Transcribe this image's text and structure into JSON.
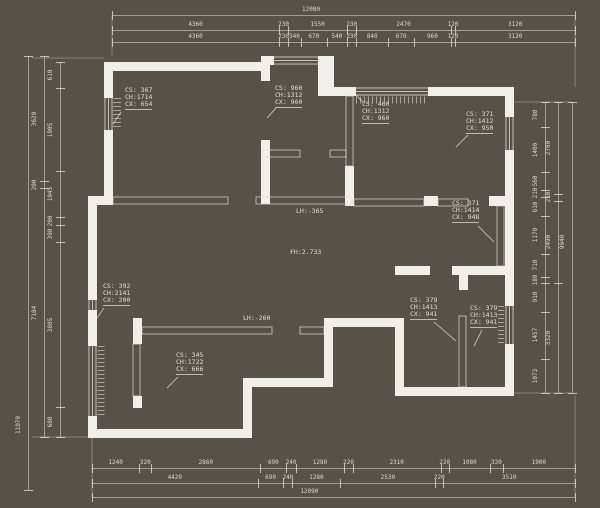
{
  "colors": {
    "background": "#5a5146",
    "wall": "#f2efe8",
    "line": "#d8d0bd",
    "text": "#e2dccb"
  },
  "dimensions": {
    "top_overall": [
      "12080"
    ],
    "top_row2": [
      "4360",
      "230",
      "1550",
      "230",
      "2470",
      "120",
      "3120"
    ],
    "top_row3": [
      "4360",
      "230",
      "340",
      "670",
      "540",
      "230",
      "840",
      "670",
      "960",
      "120",
      "3120"
    ],
    "bottom_row1": [
      "1240",
      "320",
      "2860",
      "690",
      "240",
      "1280",
      "220",
      "2310",
      "220",
      "1080",
      "330",
      "1900"
    ],
    "bottom_row2": [
      "4420",
      "690",
      "240",
      "1280",
      "2530",
      "220",
      "3510"
    ],
    "bottom_overall": [
      "12090"
    ],
    "left_overall": [
      "11070"
    ],
    "left_middle": [
      "3620",
      "200",
      "7184"
    ],
    "left_inner": [
      "610",
      "1905",
      "1045",
      "200",
      "390",
      "3805",
      "680"
    ],
    "right_inner": [
      "780",
      "1400",
      "560",
      "210",
      "610",
      "1170",
      "710",
      "180",
      "910",
      "1457",
      "1073"
    ],
    "right_middle": [
      "2780",
      "210",
      "2490",
      "3320"
    ],
    "right_overall": [
      "9940"
    ]
  },
  "cs_labels": [
    {
      "l1": "CS: 367",
      "l2": "CH:1714",
      "l3": "CX: 654"
    },
    {
      "l1": "CS: 960",
      "l2": "CH:1312",
      "l3": "CX: 960"
    },
    {
      "l1": "CS: 460",
      "l2": "CH:1312",
      "l3": "CX: 960"
    },
    {
      "l1": "CS: 371",
      "l2": "CH:1412",
      "l3": "CX: 950"
    },
    {
      "l1": "CS: 371",
      "l2": "CH:1414",
      "l3": "CX: 948"
    },
    {
      "l1": "CS: 392",
      "l2": "CH:2141",
      "l3": "CX: 200"
    },
    {
      "l1": "CS: 345",
      "l2": "CH:1722",
      "l3": "CX: 666"
    },
    {
      "l1": "CS: 379",
      "l2": "CH:1413",
      "l3": "CX: 941"
    },
    {
      "l1": "CS: 379",
      "l2": "CH:1413",
      "l3": "CX: 941"
    }
  ],
  "level_labels": {
    "lh_upper": "LH:-365",
    "fh_center": "FH:2.733",
    "lh_lower": "LH:-260"
  }
}
